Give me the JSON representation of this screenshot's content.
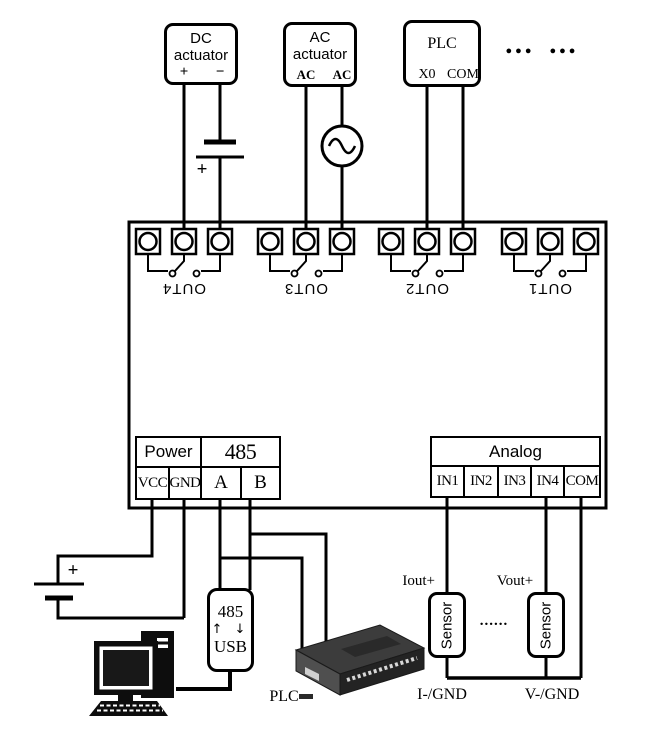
{
  "devices": {
    "dc_actuator": {
      "label": "DC actuator",
      "terminal_plus": "+",
      "terminal_minus": "−"
    },
    "ac_actuator": {
      "label": "AC actuator",
      "terminal_left": "AC",
      "terminal_right": "AC"
    },
    "plc": {
      "label": "PLC",
      "terminal_left": "X0",
      "terminal_right": "COM"
    },
    "more_devices_ellipsis": "●●● ●●●"
  },
  "module": {
    "outputs": [
      {
        "label": "OUT4"
      },
      {
        "label": "OUT3"
      },
      {
        "label": "OUT2"
      },
      {
        "label": "OUT1"
      }
    ],
    "power": {
      "header": "Power",
      "terminals": [
        "VCC",
        "GND"
      ]
    },
    "rs485": {
      "header": "485",
      "terminals": [
        "A",
        "B"
      ]
    },
    "analog": {
      "header": "Analog",
      "terminals": [
        "IN1",
        "IN2",
        "IN3",
        "IN4",
        "COM"
      ]
    }
  },
  "bottom": {
    "dc_supply_polarity": "+",
    "power_supply_polarity": "+",
    "usb_converter": {
      "line1": "485",
      "arrows": "↑ ↓",
      "line2": "USB"
    },
    "plc_device_label": "PLC",
    "sensor_current": {
      "label": "Sensor",
      "output_label": "Iout+",
      "return_label": "I-/GND"
    },
    "sensor_voltage": {
      "label": "Sensor",
      "output_label": "Vout+",
      "return_label": "V-/GND"
    },
    "sensors_ellipsis": "......"
  },
  "colors": {
    "wire": "#000000",
    "background": "#ffffff"
  }
}
